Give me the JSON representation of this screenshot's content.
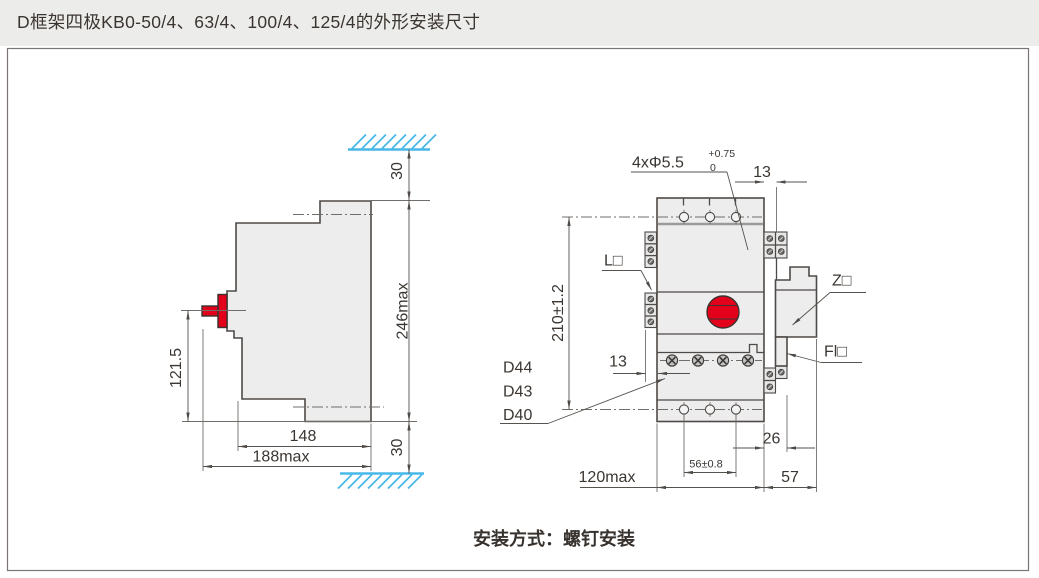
{
  "title": "D框架四极KB0-50/4、63/4、100/4、125/4的外形安装尺寸",
  "footer": "安装方式：螺钉安装",
  "colors": {
    "accent_red": "#e2001a",
    "hatch_blue": "#49b8e8",
    "body_fill": "#ededed",
    "line": "#4e4a47",
    "titlebar_bg": "#ececea"
  },
  "side_view": {
    "dim_handle_height": "121.5",
    "dim_width_inner": "148",
    "dim_width_overall": "188max",
    "dim_height_overall": "246max",
    "dim_clearance_top": "30",
    "dim_clearance_bottom": "30"
  },
  "front_view": {
    "hole_callout": "4xΦ5.5",
    "hole_tol_upper": "+0.75",
    "hole_tol_lower": "0",
    "dim_top_offset": "13",
    "dim_mount_height": "210±1.2",
    "dim_side_offset": "13",
    "dim_hole_spacing": "56±0.8",
    "dim_width_body": "120max",
    "dim_accessory_offset": "26",
    "dim_accessory_width": "57",
    "label_left_accessory": "L□",
    "label_right_accessory": "Z□",
    "label_fl_accessory": "Fl□",
    "label_d44": "D44",
    "label_d43": "D43",
    "label_d40": "D40"
  }
}
